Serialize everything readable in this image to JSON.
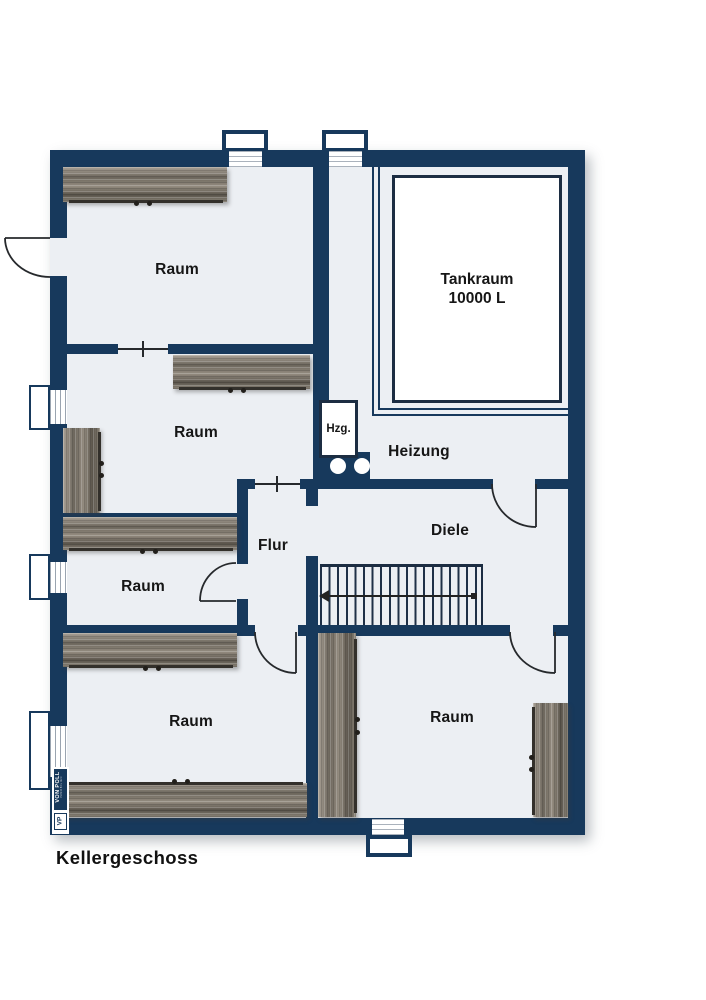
{
  "plan": {
    "title": "Kellergeschoss",
    "rooms": {
      "raum_top_left": "Raum",
      "raum_mid_left": "Raum",
      "raum_lower_left": "Raum",
      "raum_bottom_left": "Raum",
      "raum_bottom_right": "Raum",
      "tankraum_line1": "Tankraum",
      "tankraum_line2": "10000 L",
      "heizung": "Heizung",
      "diele": "Diele",
      "flur": "Flur",
      "hzg": "Hzg."
    },
    "logo": {
      "brand": "VON POLL",
      "division": "IMMOBILIEN",
      "monogram": "VP"
    },
    "colors": {
      "wall": "#17395c",
      "floor": "#eceff3",
      "line": "#26292c",
      "label": "#161616",
      "wood_light": "#a9a196",
      "wood_dark": "#5a544b"
    }
  }
}
